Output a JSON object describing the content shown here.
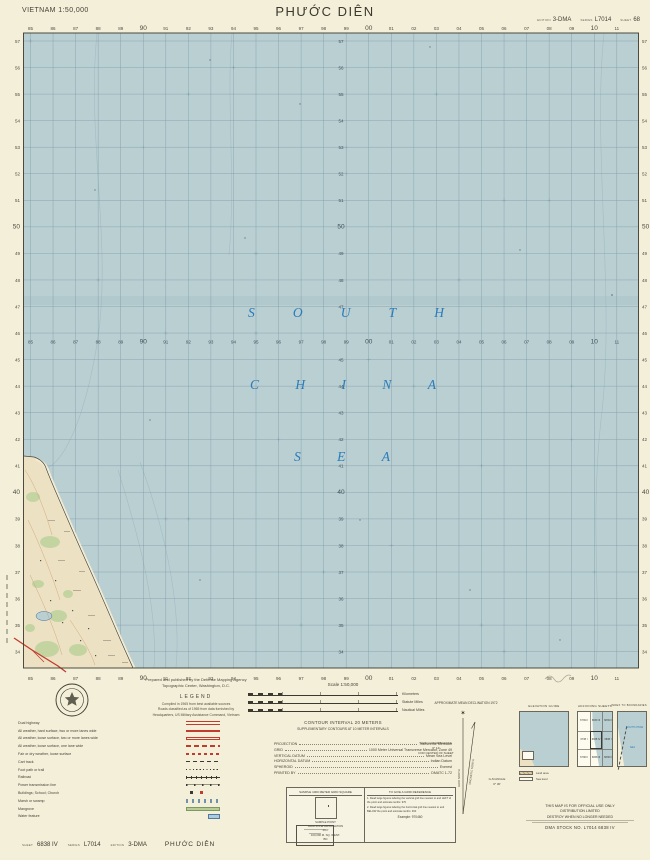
{
  "header": {
    "country_scale": "VIETNAM 1:50,000",
    "title": "PHƯỚC DIÊN",
    "edition_label": "EDITION",
    "edition": "3-DMA",
    "series_label": "SERIES",
    "series": "L7014",
    "sheet_label": "SHEET",
    "sheet": "68"
  },
  "map": {
    "sea_name": [
      "SOUTH",
      "CHINA",
      "SEA"
    ],
    "grid": {
      "eastings": [
        "85",
        "86",
        "87",
        "88",
        "89",
        "90",
        "91",
        "92",
        "93",
        "94",
        "95",
        "96",
        "97",
        "98",
        "99",
        "00",
        "01",
        "02",
        "03",
        "04",
        "05",
        "06",
        "07",
        "08",
        "09",
        "10",
        "11"
      ],
      "northings": [
        "57",
        "56",
        "55",
        "54",
        "53",
        "52",
        "51",
        "50",
        "49",
        "48",
        "47",
        "46",
        "45",
        "44",
        "43",
        "42",
        "41",
        "40",
        "39",
        "38",
        "37",
        "36",
        "35",
        "34"
      ],
      "emphasized_eastings": [
        "90",
        "00",
        "10"
      ],
      "emphasized_northings": [
        "50",
        "40"
      ]
    },
    "colors": {
      "sea": "#b9cfd2",
      "land": "#ede1c3",
      "grid_line": "#7f99a7",
      "sea_text": "#2b7cba",
      "vegetation": "#c2d4a0",
      "road": "#c23b2e",
      "contour": "#c49a6a",
      "paper": "#f4efd8"
    }
  },
  "footer": {
    "credit1": "Prepared and published by the Defense Mapping Agency",
    "credit2": "Topographic Center, Washington, D.C.",
    "legend_heading": "LEGEND",
    "compiled_note": "Compiled in 1965 from best available sources",
    "classification_note1": "Roads classified as of 1965 from data furnished by",
    "classification_note2": "Headquarters, US Military Assistance Command, Vietnam",
    "legend_items": [
      {
        "label": "Dual highway",
        "sym": "dual"
      },
      {
        "label": "All weather, hard surface, two or more lanes wide",
        "sym": "hard"
      },
      {
        "label": "All weather, loose surface, two or more lanes wide",
        "sym": "loose2"
      },
      {
        "label": "All weather, loose surface, one lane wide",
        "sym": "loose1"
      },
      {
        "label": "Fair or dry weather, loose surface",
        "sym": "fair"
      },
      {
        "label": "Cart track",
        "sym": "cart"
      },
      {
        "label": "Foot path or trail",
        "sym": "trail"
      },
      {
        "label": "Railroad",
        "sym": "rail"
      },
      {
        "label": "Power transmission line",
        "sym": "power"
      },
      {
        "label": "Buildings; School; Church",
        "sym": "bldg"
      },
      {
        "label": "Marsh or swamp",
        "sym": "swamp"
      },
      {
        "label": "Mangrove",
        "sym": "mangrove"
      },
      {
        "label": "Water feature",
        "sym": "water"
      }
    ],
    "scale": {
      "title": "Scale 1:50,000",
      "ticks": "1  ½  0  1  2  3",
      "bars": [
        {
          "unit": "Kilometers"
        },
        {
          "unit": "Statute Miles"
        },
        {
          "unit": "Nautical Miles"
        }
      ]
    },
    "contour_note1": "CONTOUR INTERVAL 20 METERS",
    "contour_note2": "SUPPLEMENTARY CONTOURS AT 10 METER INTERVALS",
    "projection_rows": [
      {
        "label": "PROJECTION",
        "value": "Transverse Mercator"
      },
      {
        "label": "GRID",
        "value": "1000 Meter Universal Transverse Mercator, Zone 49"
      },
      {
        "label": "VERTICAL DATUM",
        "value": "Mean Sea Level"
      },
      {
        "label": "HORIZONTAL DATUM",
        "value": "Indian Datum"
      },
      {
        "label": "SPHEROID",
        "value": "Everest"
      },
      {
        "label": "PRINTED BY",
        "value": "DMATC 1-72"
      }
    ],
    "gridref": {
      "left_header": "SAMPLE 1000 METER GRID SQUARE",
      "sample_point_label": "SAMPLE POINT",
      "zone_label": "GRID ZONE DESIGNATION",
      "zone_value": "49 P",
      "ident_label": "100,000 M. SQ. IDENT.",
      "ident_value": "BN",
      "right_header": "TO GIVE A GRID REFERENCE",
      "steps": [
        "1. Read large figures labeling the vertical grid line nearest to and LEFT of the point and estimate tenths: 970",
        "2. Read large figures labeling the horizontal grid line nearest to and BELOW the point and estimate tenths: 460"
      ],
      "example": "Example: 970460"
    },
    "declination": {
      "caption": "APPROXIMATE MEAN DECLINATION 1972",
      "left_note1": "GRID CONVERGENCE",
      "left_note2": "0° 14′",
      "left_note3": "FOR CENTER OF SHEET",
      "right_note1": "G-M ANGLE",
      "right_note2": "0° 30′",
      "grid_north": "GRID NORTH",
      "magnetic_north": "MAGNETIC NORTH"
    },
    "boxes": {
      "elevation_header": "ELEVATION GUIDE",
      "adjoining_header": "ADJOINING SHEETS",
      "boundaries_header": "INDEX TO BOUNDARIES",
      "adjoining_sheets": [
        [
          "6739 II",
          "6839 III",
          "6839 II"
        ],
        [
          "6738 I",
          "6838 IV",
          "6838 I"
        ],
        [
          "6738 II",
          "6838 III",
          "6838 II"
        ]
      ],
      "boundaries_sea_label1": "SOUTH CHINA",
      "boundaries_sea_label2": "SEA",
      "elevation_legend": [
        {
          "label": "Land area"
        },
        {
          "label": "Sea level"
        }
      ]
    },
    "security": {
      "line1": "THIS MAP IS FOR OFFICIAL USE ONLY",
      "line2": "DISTRIBUTION LIMITED",
      "line3": "DESTROY WHEN NO LONGER NEEDED",
      "stock": "DMA STOCK NO. L7014 6838 IV"
    },
    "bottom": {
      "sheet_label": "SHEET",
      "sheet": "6838 IV",
      "series_label": "SERIES",
      "series": "L7014",
      "edition_label": "EDITION",
      "edition": "3-DMA",
      "title": "PHƯỚC DIÊN"
    }
  }
}
